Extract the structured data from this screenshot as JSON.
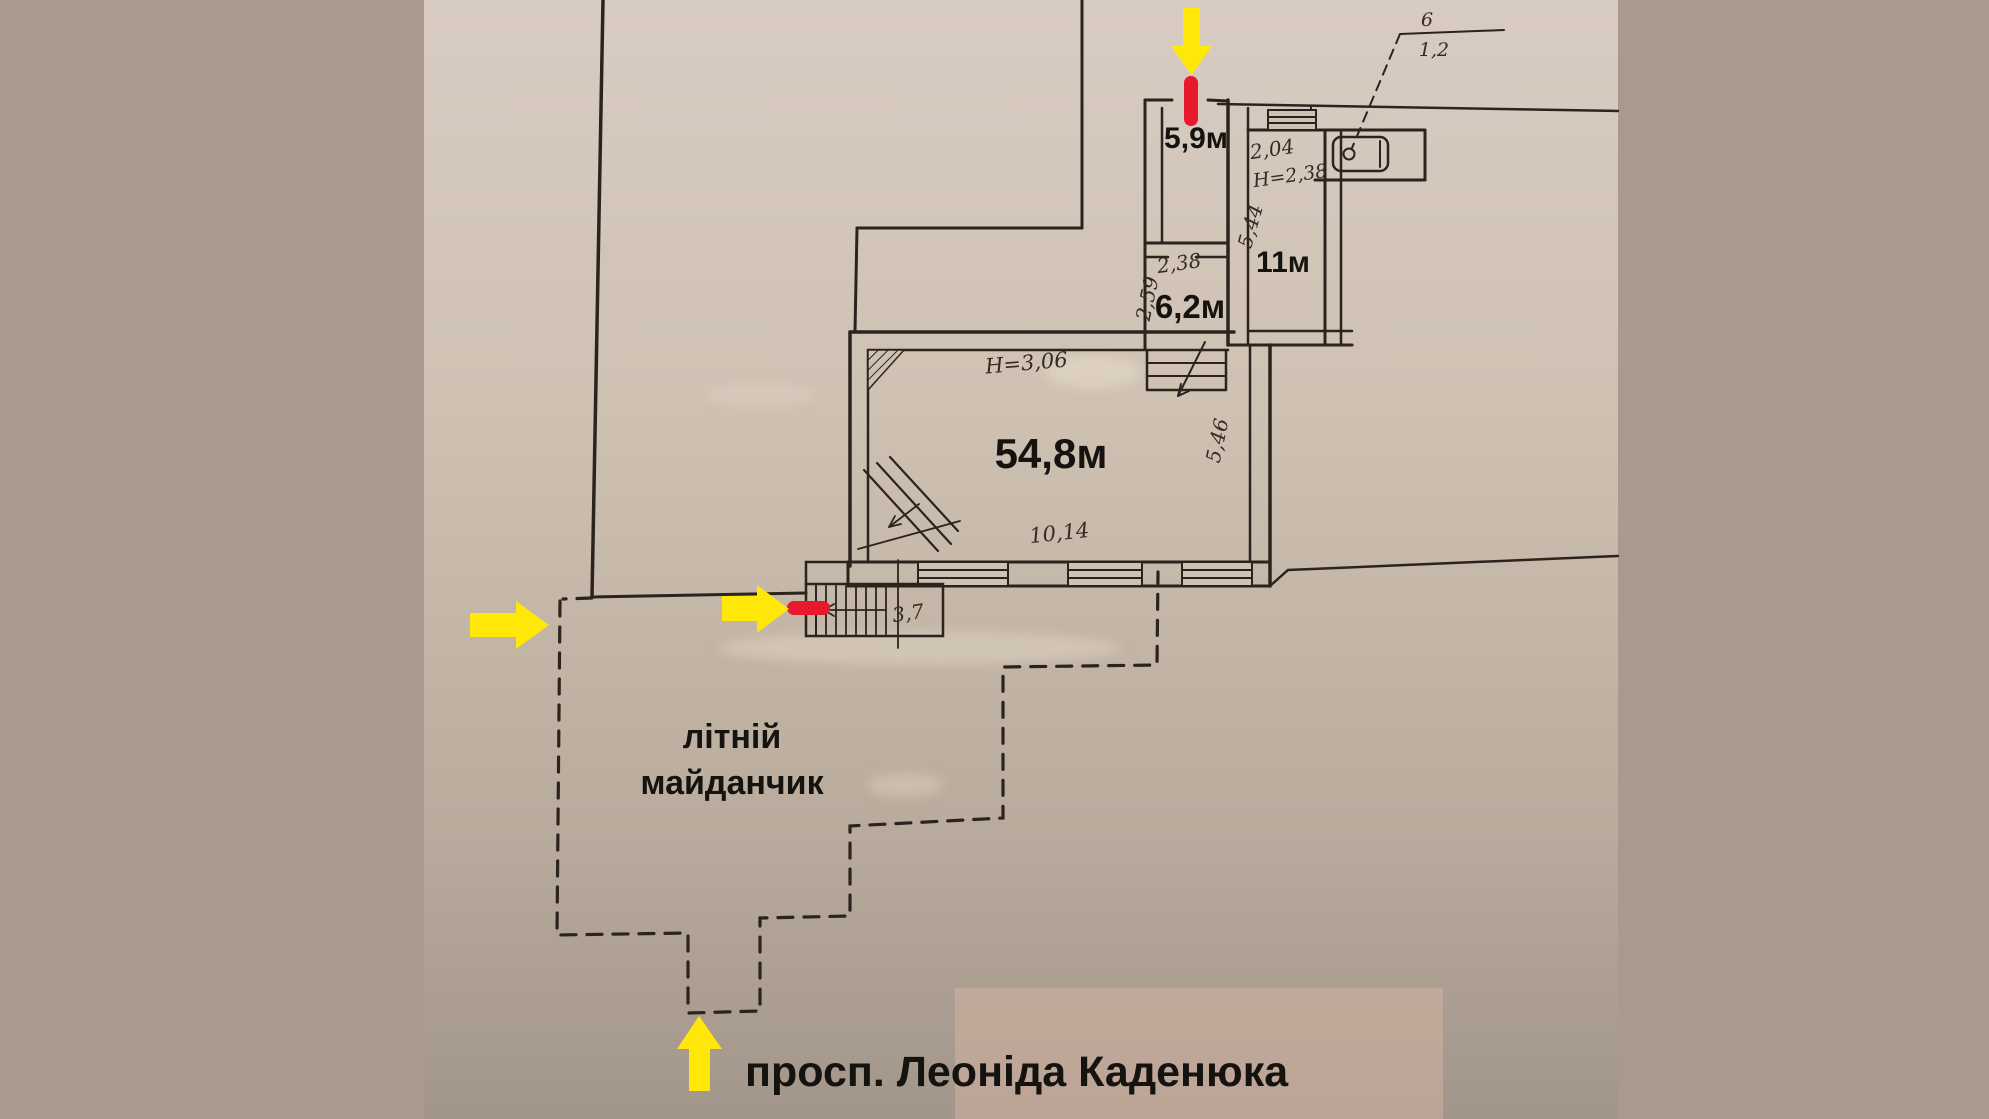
{
  "plan": {
    "rooms": {
      "hall_small": "5,9м",
      "room_11": "11м",
      "room_6_2": "6,2м",
      "main_hall": "54,8м"
    },
    "dims": {
      "d238": "2,38",
      "d259": "2,59",
      "d204": "2,04",
      "h238": "Н=2,38",
      "d544": "5,44",
      "d546": "5,46",
      "h306": "Н=3,06",
      "d1014": "10,14",
      "d37": "3,7",
      "ref6": "6",
      "d12": "1,2"
    },
    "labels": {
      "terrace_line1": "літній",
      "terrace_line2": "майданчик",
      "street": "просп. Леоніда Каденюка"
    }
  },
  "colors": {
    "arrow": "#ffe70a",
    "door_marker": "#e8192c",
    "ink": "#2b241e",
    "paper_top": "#d8cbc2",
    "paper_bottom": "#a2958a"
  }
}
